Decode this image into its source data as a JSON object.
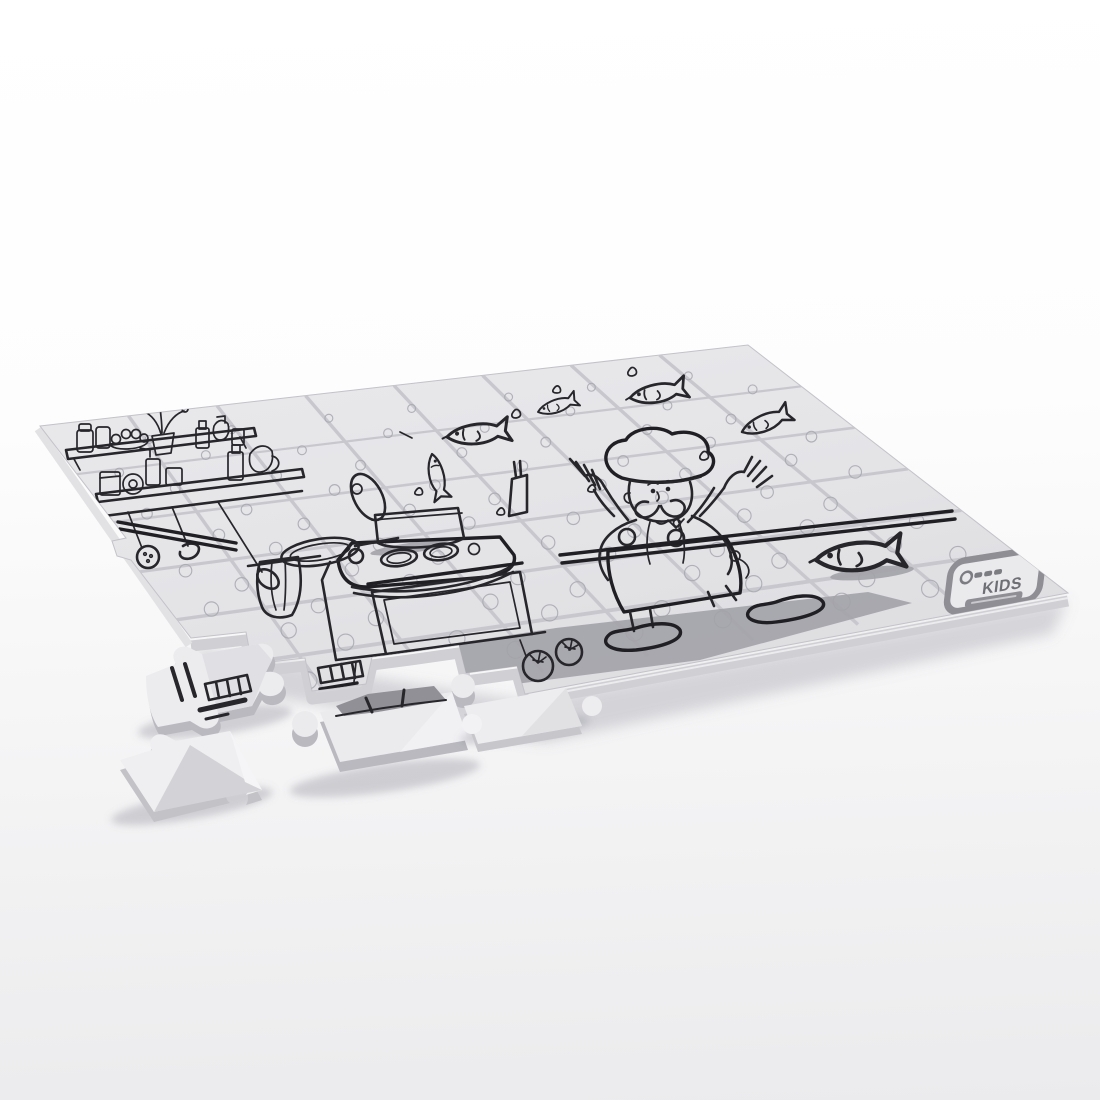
{
  "scene": {
    "title": "Partially assembled blank colouring jigsaw puzzle — cartoon chef juggling fish in a kitchen (black line art on white pieces), four loose pieces in front",
    "background_top": "#ffffff",
    "background_bottom": "#ebebed"
  },
  "board": {
    "rows": 6,
    "cols": 8,
    "total_pieces": 48,
    "missing_pieces_bottom_left": 5,
    "surface_color": "#e4e4e7",
    "channel_color": "#c7c7cd",
    "outline_color": "#a7a7b0",
    "art_color": "#26262b",
    "shadow_color": "#a2a2a9",
    "side_color": "#cfcfd4",
    "artwork": [
      "cartoon chef with tall hat juggling fish",
      "five fish leaping through the air",
      "fish lying on the countertop",
      "stove with oven door",
      "pot with tilted lid and standing knife",
      "frying pan",
      "kitchen shelves with jars, bottles, fruit bowl and plant",
      "hanging skimmer, ladle and spoon",
      "kitchen towel",
      "two tomatoes",
      "splash droplets"
    ]
  },
  "brand_badge": {
    "text": "KIDS",
    "frame_color": "#8e8e94",
    "text_color": "#6e6e75"
  },
  "loose_pieces": [
    {
      "label": "loose piece with oven grill artwork"
    },
    {
      "label": "blank corner piece"
    },
    {
      "label": "loose piece with shaded artwork"
    },
    {
      "label": "blank edge piece"
    }
  ]
}
